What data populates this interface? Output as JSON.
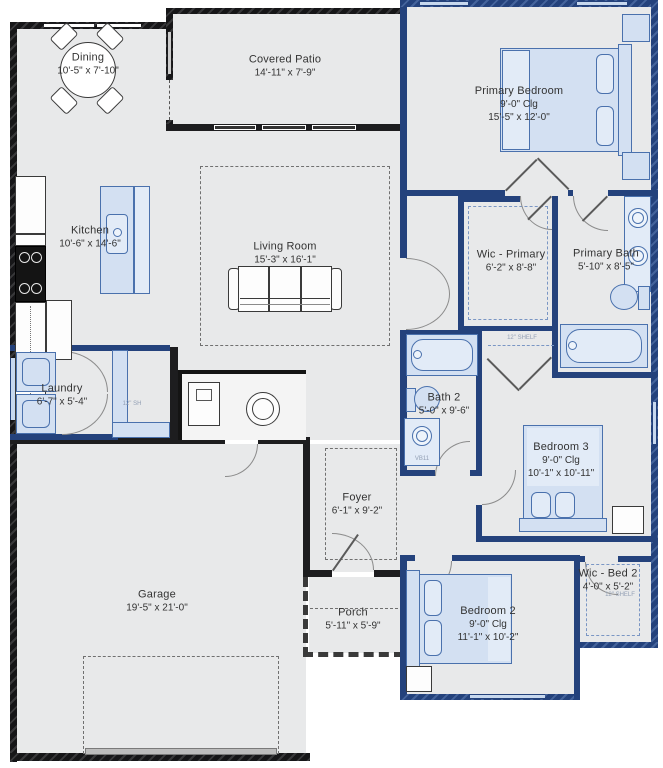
{
  "plan": {
    "rooms": {
      "dining": {
        "name": "Dining",
        "dims": "10'-5\" x 7'-10\""
      },
      "covered_patio": {
        "name": "Covered Patio",
        "dims": "14'-11\" x 7'-9\""
      },
      "primary_bedroom": {
        "name": "Primary Bedroom",
        "ceiling": "9'-0\" Clg",
        "dims": "15'-5\" x 12'-0\""
      },
      "kitchen": {
        "name": "Kitchen",
        "dims": "10'-6\" x 14'-6\""
      },
      "living_room": {
        "name": "Living Room",
        "dims": "15'-3\" x 16'-1\""
      },
      "wic_primary": {
        "name": "Wic - Primary",
        "dims": "6'-2\" x 8'-8\""
      },
      "primary_bath": {
        "name": "Primary Bath",
        "dims": "5'-10\" x 8'-5\""
      },
      "laundry": {
        "name": "Laundry",
        "dims": "6'-7\" x 5'-4\""
      },
      "bath2": {
        "name": "Bath 2",
        "dims": "5'-0\" x 9'-6\""
      },
      "bedroom3": {
        "name": "Bedroom 3",
        "ceiling": "9'-0\" Clg",
        "dims": "10'-1\" x 10'-11\""
      },
      "foyer": {
        "name": "Foyer",
        "dims": "6'-1\" x 9'-2\""
      },
      "garage": {
        "name": "Garage",
        "dims": "19'-5\" x 21'-0\""
      },
      "porch": {
        "name": "Porch",
        "dims": "5'-11\" x 5'-9\""
      },
      "bedroom2": {
        "name": "Bedroom 2",
        "ceiling": "9'-0\" Clg",
        "dims": "11'-1\" x 10'-2\""
      },
      "wic_bed2": {
        "name": "Wic - Bed 2",
        "dims": "4'-0\" x 5'-2\""
      }
    },
    "annotations": {
      "shelf_note_primary": "12\" SHELF",
      "shelf_note_bed2": "12\" SHELF",
      "vanity_code": "VB11",
      "closet_note": "12\" SH"
    },
    "colors": {
      "wall_dark": "#1d1d1f",
      "wall_blue": "#24427c",
      "floor": "#e8e9ea",
      "furniture_fill": "#d3e0f2",
      "furniture_line": "#4a71ad",
      "window_light": "#c7d8ee"
    }
  }
}
